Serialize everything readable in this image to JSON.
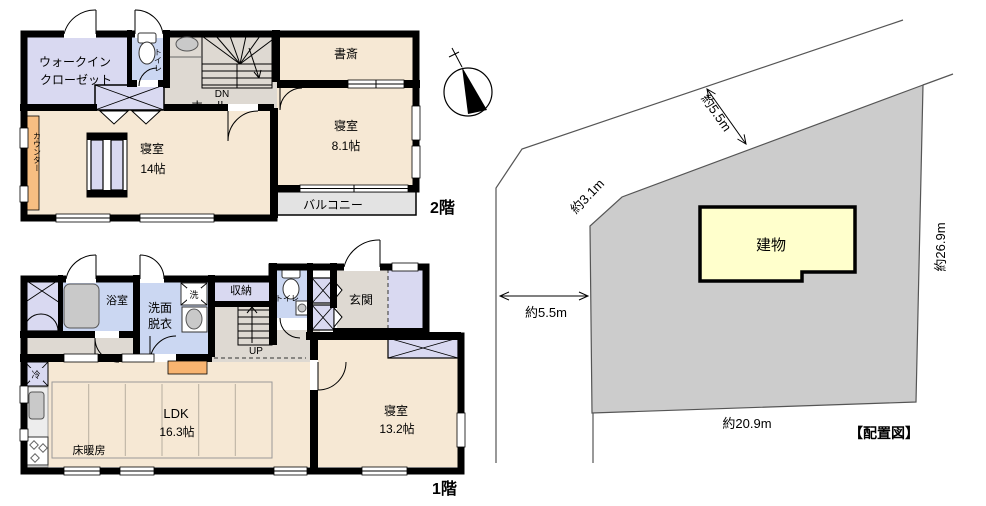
{
  "second_floor": {
    "floor_label": "2階",
    "rooms": {
      "walk_in_closet_line1": "ウォークイン",
      "walk_in_closet_line2": "クローゼット",
      "toilet": "トイレ",
      "hall": "ホール",
      "stairs_direction": "DN",
      "study": "書斎",
      "bedroom_main_name": "寝室",
      "bedroom_main_size": "14帖",
      "bedroom_sub_name": "寝室",
      "bedroom_sub_size": "8.1帖",
      "balcony": "バルコニー",
      "counter": "カウンター"
    }
  },
  "first_floor": {
    "floor_label": "1階",
    "rooms": {
      "bathroom": "浴室",
      "washroom_line1": "洗面",
      "washroom_line2": "脱衣",
      "washer": "洗",
      "storage": "収納",
      "toilet": "トイレ",
      "entrance": "玄関",
      "stairs_direction": "UP",
      "refrigerator": "冷",
      "ldk_name": "LDK",
      "ldk_size": "16.3帖",
      "floor_heating": "床暖房",
      "bedroom_name": "寝室",
      "bedroom_size": "13.2帖"
    }
  },
  "site_plan": {
    "caption": "【配置図】",
    "building_label": "建物",
    "dim_road_top": "約5.5m",
    "dim_corner": "約3.1m",
    "dim_road_left": "約5.5m",
    "dim_east_side": "約26.9m",
    "dim_south_side": "約20.9m"
  },
  "colors": {
    "wall": "#000000",
    "room_beige": "#F6E8D4",
    "closet_lavender": "#D9D9F1",
    "wet_area_blue": "#CBD7F2",
    "hall_gray": "#DED9D2",
    "balcony_gray": "#E3E3E3",
    "counter_orange": "#F7BE82",
    "step_orange": "#F8B470",
    "site_gray": "#CCCCCC",
    "building_yellow": "#FFFFCC"
  }
}
